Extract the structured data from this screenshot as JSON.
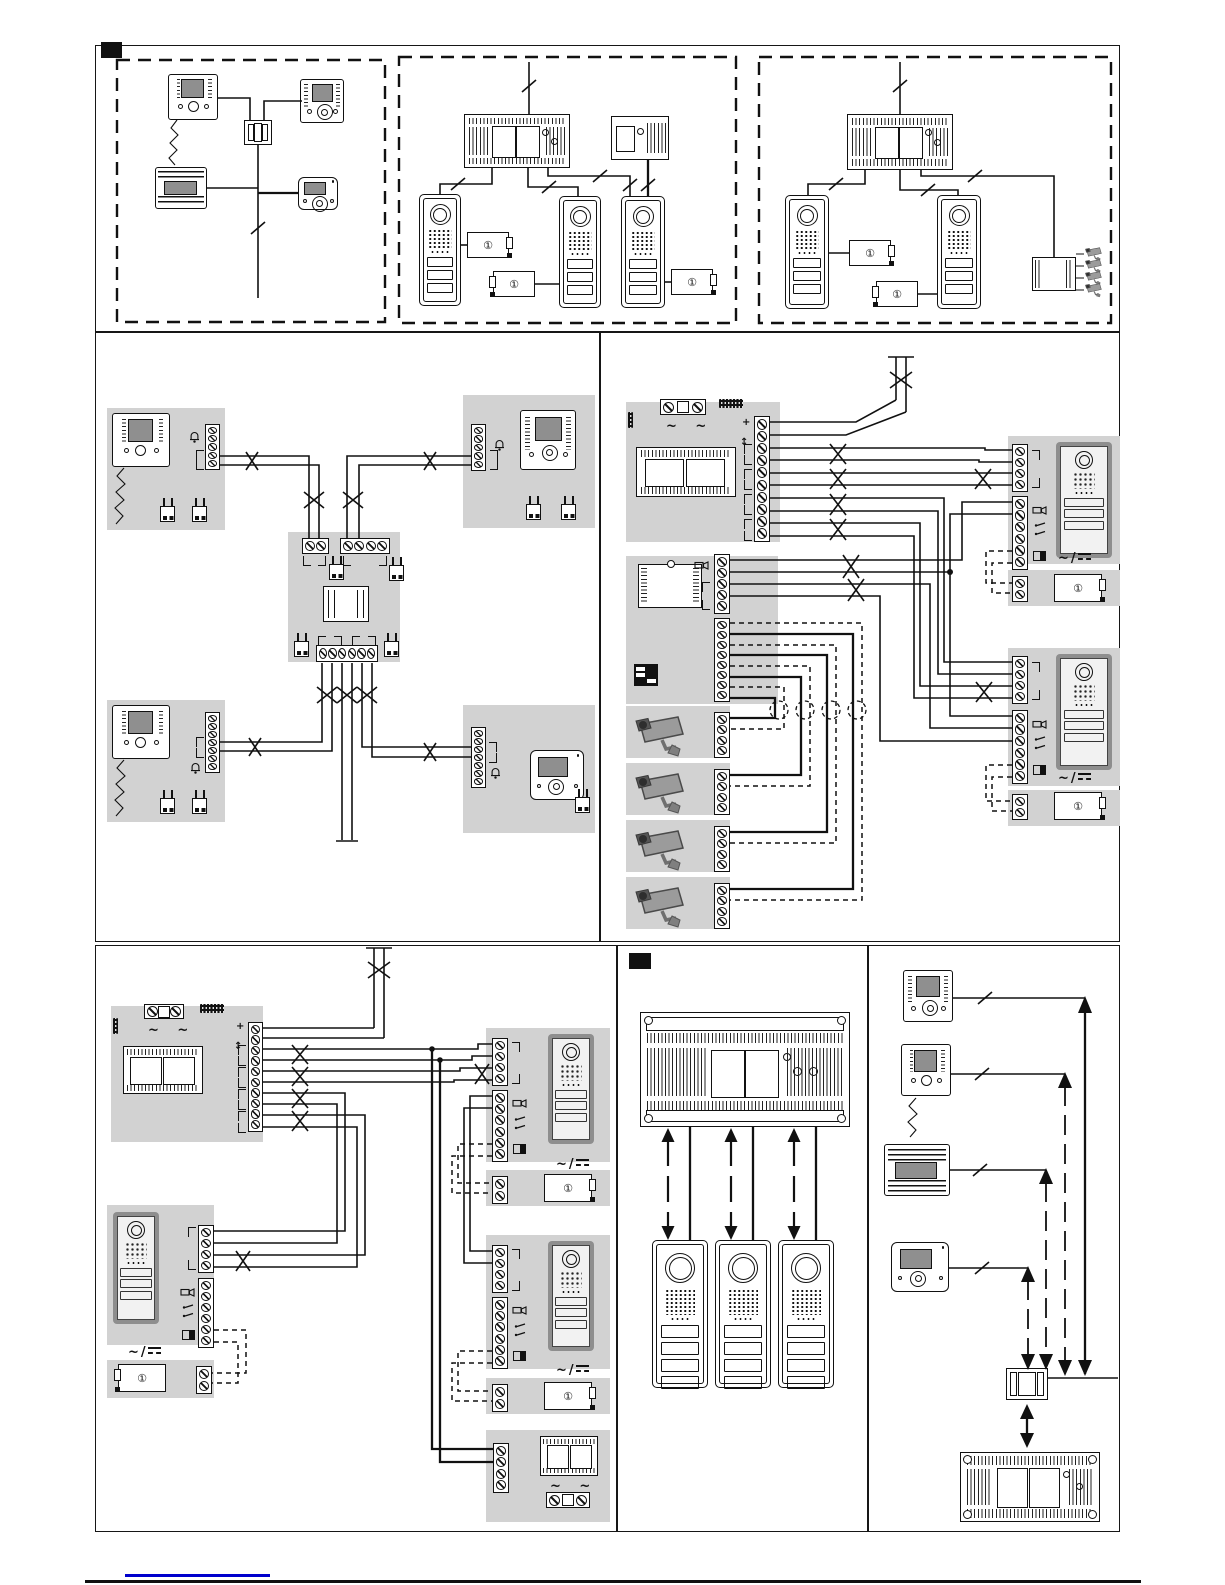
{
  "page": {
    "width": 1225,
    "height": 1585,
    "background": "#ffffff"
  },
  "colors": {
    "line": "#111111",
    "panel_gray": "#d2d2d2",
    "photo_frame": "#8e8e8e",
    "screen_gray": "#8f8f8f",
    "link_blue": "#0000cc"
  },
  "icons": {
    "lock_release": "①",
    "ac": "~",
    "ac_pair": "~ ~",
    "slash": "/",
    "plus": "+",
    "up_down": "↕"
  },
  "sections": {
    "top_left": {
      "label": "overview-single-riser",
      "devices": [
        "video-handset-monitor",
        "video-handsfree-monitor",
        "audio-intercom-unit",
        "compact-video-monitor",
        "distribution-box"
      ]
    },
    "top_middle": {
      "label": "overview-three-entrances",
      "devices": [
        "main-power-supply",
        "auxiliary-power-supply",
        "entrance-panel x3",
        "lock-release x3"
      ]
    },
    "top_right": {
      "label": "overview-with-cctv",
      "devices": [
        "main-power-supply",
        "entrance-panel x2",
        "lock-release x2",
        "camera-interface",
        "cctv-camera x4"
      ]
    },
    "middle_left": {
      "label": "apartment-wiring-floor-distributor",
      "devices": [
        "video-handset-monitor x2",
        "video-handsfree-monitor",
        "compact-video-monitor",
        "floor-distributor",
        "jumper x7"
      ]
    },
    "middle_right": {
      "label": "riser-wiring-with-camera-interface",
      "devices": [
        "power-supply-panel",
        "camera-interface-module",
        "cctv-camera x4",
        "entrance-panel x2",
        "lock-release x2"
      ]
    },
    "bottom_left": {
      "label": "riser-wiring-three-entrances",
      "devices": [
        "power-supply-panel",
        "entrance-panel x3",
        "lock-release x3",
        "bell-transformer"
      ]
    },
    "bottom_middle": {
      "label": "switcher-block-diagram",
      "devices": [
        "switcher-power-unit",
        "entrance-panel x3"
      ]
    },
    "bottom_right": {
      "label": "system-tree-diagram",
      "devices": [
        "video-handsfree-monitor",
        "video-handset-monitor",
        "audio-intercom-unit",
        "compact-video-monitor",
        "junction-box",
        "power-supply-unit"
      ]
    }
  }
}
